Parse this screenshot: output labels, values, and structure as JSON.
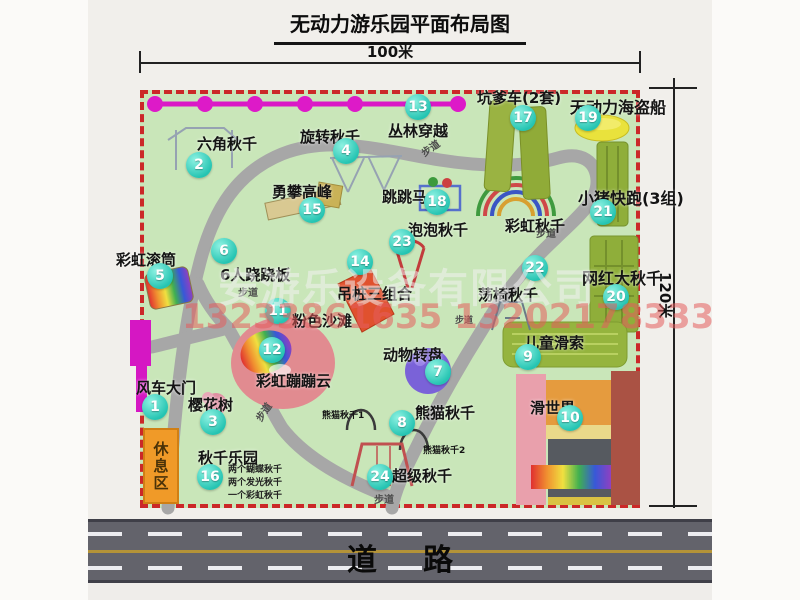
{
  "title": "无动力游乐园平面布局图",
  "dimensions": {
    "width_label": "100米",
    "height_label": "120米"
  },
  "road": {
    "label": "道路"
  },
  "watermark": {
    "company": "安游乐设备有限公司",
    "phone": "13233861635 13202178333"
  },
  "labels": {
    "rest_area": "休息区",
    "rainbow_swing": "彩虹秋千",
    "panda_swing_1": "熊猫秋千1",
    "panda_swing_2": "熊猫秋千2",
    "path": "步道"
  },
  "swing_park_note": [
    "两个蝴蝶秋千",
    "两个发光秋千",
    "一个彩虹秋千"
  ],
  "colors": {
    "map_green": "#c9e6b9",
    "border_red": "#cb2828",
    "marker_teal": "#25c4b2",
    "zipline_magenta": "#da18c6",
    "gate_magenta": "#d517c3",
    "road_gray": "#63636b",
    "rest_orange": "#f09a28",
    "olive_green": "#8fae3a",
    "pirate_yellow": "#e9e23c"
  },
  "attractions": [
    {
      "num": "1",
      "label": "风车大门"
    },
    {
      "num": "2",
      "label": "六角秋千"
    },
    {
      "num": "3",
      "label": "樱花树"
    },
    {
      "num": "4",
      "label": "旋转秋千"
    },
    {
      "num": "5",
      "label": "彩虹滚筒"
    },
    {
      "num": "6",
      "label": "6人跷跷板"
    },
    {
      "num": "7",
      "label": "动物转盘"
    },
    {
      "num": "8",
      "label": "熊猫秋千"
    },
    {
      "num": "9",
      "label": "儿童滑索"
    },
    {
      "num": "10",
      "label": "滑世界"
    },
    {
      "num": "11",
      "label": "粉色沙滩"
    },
    {
      "num": "12",
      "label": "彩虹蹦蹦云"
    },
    {
      "num": "13",
      "label": "丛林穿越"
    },
    {
      "num": "14",
      "label": "吊桩三组合"
    },
    {
      "num": "15",
      "label": "勇攀高峰"
    },
    {
      "num": "16",
      "label": "秋千乐园"
    },
    {
      "num": "17",
      "label": "坑爹车(2套)"
    },
    {
      "num": "18",
      "label": "跳跳马"
    },
    {
      "num": "19",
      "label": "无动力海盗船"
    },
    {
      "num": "20",
      "label": "网红大秋千"
    },
    {
      "num": "21",
      "label": "小猪快跑(3组)"
    },
    {
      "num": "22",
      "label": "荡椅秋千"
    },
    {
      "num": "23",
      "label": "泡泡秋千"
    },
    {
      "num": "24",
      "label": "超级秋千"
    }
  ]
}
